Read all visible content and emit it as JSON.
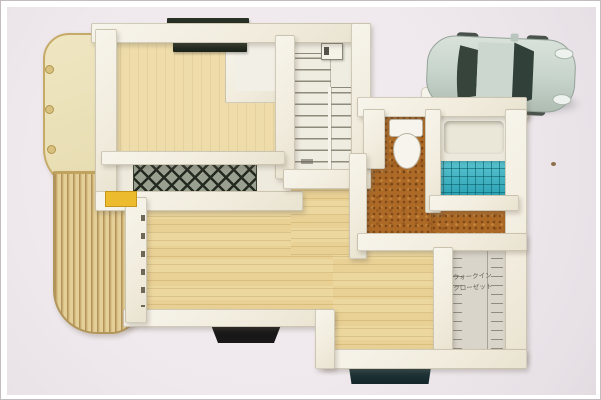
{
  "meta": {
    "type": "photograph",
    "subject": "Overhead photo of a miniature architectural house model (floor-plan maquette) with a silver toy car parked at the top right"
  },
  "palette": {
    "photo_background": "#efe9ed",
    "photo_border": "#ffffff",
    "wall_cream": "#f3efe2",
    "pale_wood_floor": "#eedcab",
    "grained_wood_floor": "#ecd79e",
    "cork_floor": "#ad6a27",
    "bath_tile_teal": "#2ab1c1",
    "lattice_dark": "#242a20",
    "deck_tan": "#d9c188",
    "terrace_cream": "#ece2bb",
    "terrace_rim_gold": "#c6aa68",
    "car_body": "#c8d5cc",
    "car_windows": "#35443c",
    "entry_step_black": "#181818",
    "entry_step_dark_teal": "#1c3034",
    "accent_yellow": "#edbb2e"
  },
  "model": {
    "areas": [
      {
        "name": "upper-left-room",
        "floor": "pale wood"
      },
      {
        "name": "closet-nook",
        "floor": "white"
      },
      {
        "name": "balcony-with-lattice",
        "floor": "white with dark diamond lattice panel"
      },
      {
        "name": "staircase",
        "flights": 2,
        "left_flight_treads": 10,
        "right_flight_treads": 8
      },
      {
        "name": "curved-terrace",
        "floor": "cream with gold rim"
      },
      {
        "name": "wood-slat-deck",
        "floor": "tan slats, curved corner"
      },
      {
        "name": "toilet-room",
        "floor": "cork",
        "fixture": "toilet"
      },
      {
        "name": "bathroom",
        "fixtures": [
          "bathtub"
        ],
        "floor": "teal tile grid"
      },
      {
        "name": "hallway",
        "floor": "cork"
      },
      {
        "name": "living-dining-room",
        "floor": "grained wood, L-shaped"
      },
      {
        "name": "walk-in-closet",
        "floor": "grey-white with pencil hatch marks"
      }
    ],
    "closet_label": {
      "line1": "ウォークイン",
      "line2": "クローゼット"
    },
    "car": {
      "kind": "toy car seen from above",
      "facing": "right",
      "body_color": "#c8d5cc",
      "window_color": "#35443c"
    }
  }
}
